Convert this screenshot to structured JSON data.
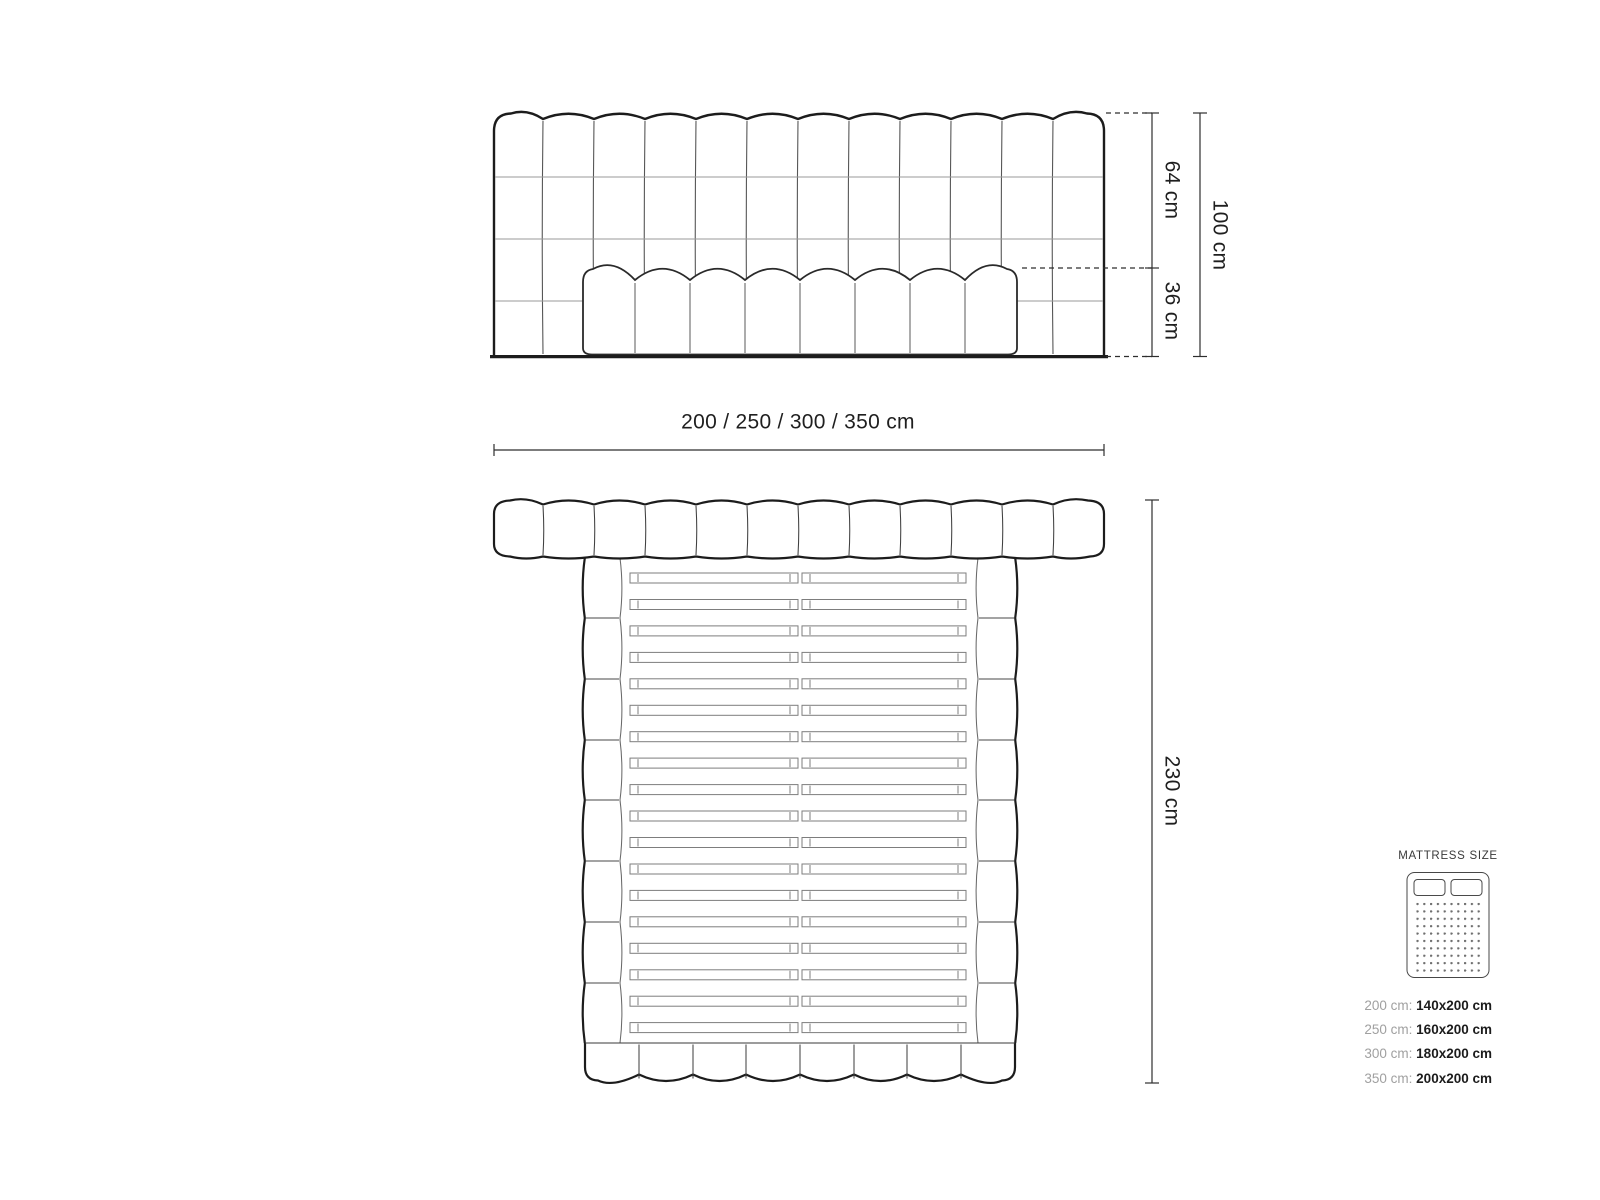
{
  "front_view": {
    "upper_height_label": "64 cm",
    "lower_height_label": "36 cm",
    "total_height_label": "100 cm",
    "width_options_label": "200 / 250 / 300 / 350 cm"
  },
  "top_view": {
    "length_label": "230 cm"
  },
  "legend": {
    "title": "MATTRESS SIZE",
    "rows": [
      {
        "frame": "200 cm:",
        "mattress": "140x200 cm"
      },
      {
        "frame": "250 cm:",
        "mattress": "160x200 cm"
      },
      {
        "frame": "300 cm:",
        "mattress": "180x200 cm"
      },
      {
        "frame": "350 cm:",
        "mattress": "200x200 cm"
      }
    ]
  },
  "colors": {
    "outline_dark": "#1c1c1c",
    "seam_mid": "#565656",
    "seam_light": "#9a9a9a",
    "dimension_line": "#2e2e2e",
    "label_gray": "#a0a0a0",
    "text_dark": "#1c1c1c"
  }
}
